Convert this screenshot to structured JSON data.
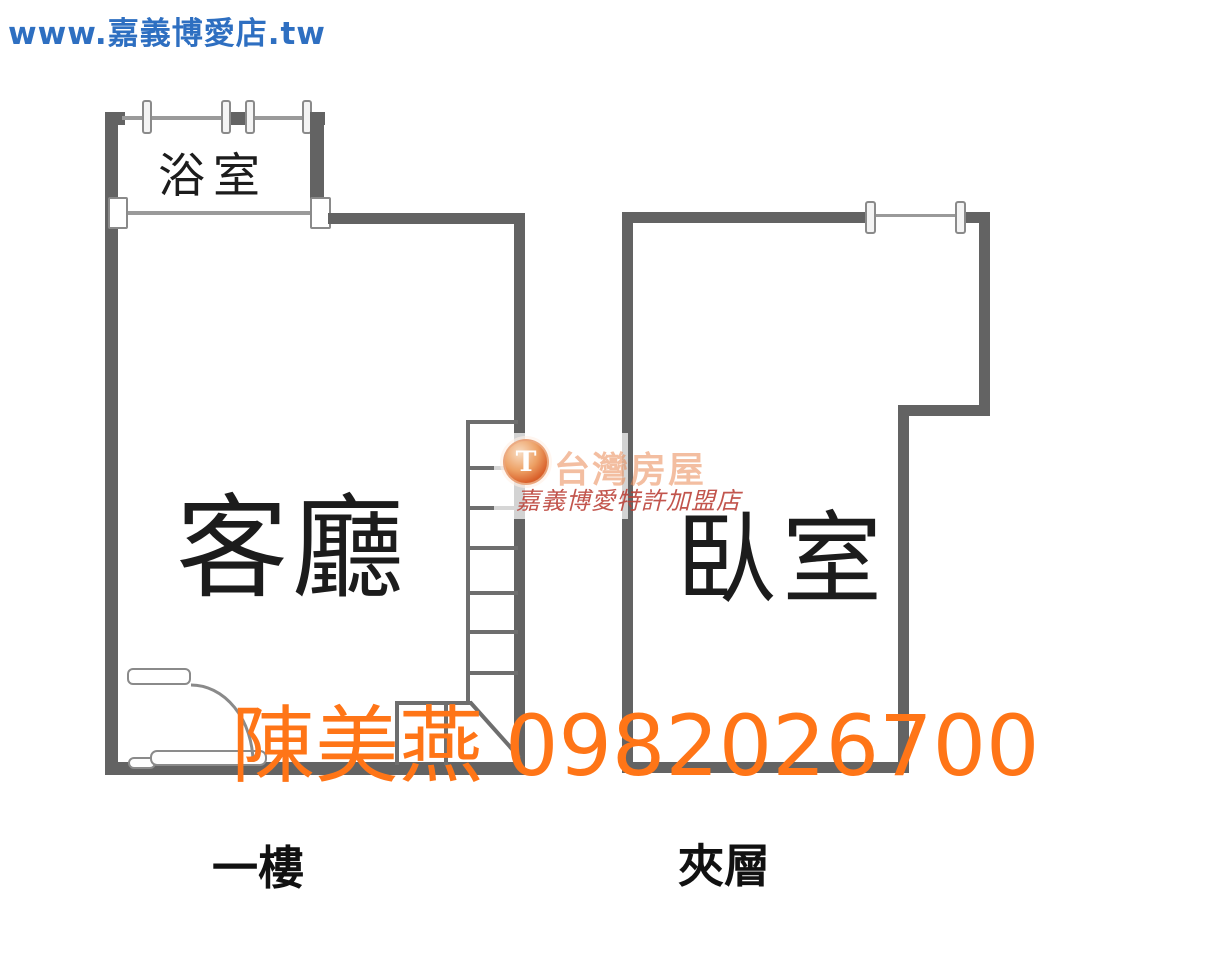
{
  "page": {
    "width": 1217,
    "height": 960,
    "background": "#ffffff"
  },
  "header": {
    "website": "www.嘉義博愛店.tw",
    "color": "#2e6fc1"
  },
  "floor_plan": {
    "unit_left": {
      "rooms": [
        {
          "name": "浴室"
        },
        {
          "name": "客廳"
        }
      ],
      "floor_label": "一樓",
      "features": [
        "staircase",
        "swing-door",
        "sliding-door",
        "windows"
      ]
    },
    "unit_right": {
      "rooms": [
        {
          "name": "臥室"
        }
      ],
      "floor_label": "夾層",
      "features": [
        "window"
      ]
    },
    "wall_color": "#636363",
    "window_line_color": "#9a9a9a",
    "stair_line_color": "#6e6e6e"
  },
  "watermark": {
    "agent_name": "陳美燕",
    "phone": "0982026700",
    "color": "#ff7517",
    "logo": {
      "symbol": "T",
      "brand": "台灣房屋",
      "branch": "嘉義博愛特許加盟店"
    }
  }
}
